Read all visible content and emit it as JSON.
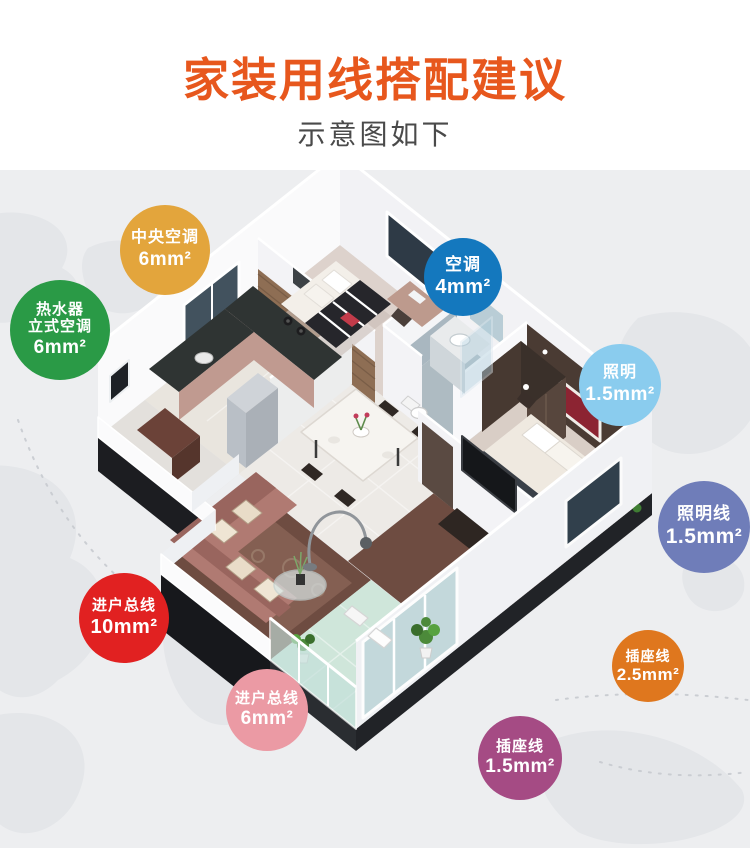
{
  "header": {
    "title": "家装用线搭配建议",
    "subtitle": "示意图如下",
    "title_color": "#e7571d",
    "subtitle_color": "#4a4a4a"
  },
  "scene": {
    "background_color": "#edeef0",
    "map_color": "#e4e6e9",
    "illustration": "isometric-apartment-cutaway"
  },
  "badges": [
    {
      "name": "central-ac",
      "label": "中央空调",
      "value": "6mm²",
      "color": "#e3a53c"
    },
    {
      "name": "water-heater-ac",
      "label": "热水器\n立式空调",
      "value": "6mm²",
      "color": "#2a9a46"
    },
    {
      "name": "ac",
      "label": "空调",
      "value": "4mm²",
      "color": "#1478be"
    },
    {
      "name": "lighting",
      "label": "照明",
      "value": "1.5mm²",
      "color": "#8accee"
    },
    {
      "name": "lighting-line",
      "label": "照明线",
      "value": "1.5mm²",
      "color": "#6f7db9"
    },
    {
      "name": "main-incoming-line",
      "label": "进户总线",
      "value": "10mm²",
      "color": "#e12121"
    },
    {
      "name": "incoming-line",
      "label": "进户总线",
      "value": "6mm²",
      "color": "#eb9aa4"
    },
    {
      "name": "socket-line-25",
      "label": "插座线",
      "value": "2.5mm²",
      "color": "#df771e"
    },
    {
      "name": "socket-line-15",
      "label": "插座线",
      "value": "1.5mm²",
      "color": "#a54b84"
    }
  ]
}
